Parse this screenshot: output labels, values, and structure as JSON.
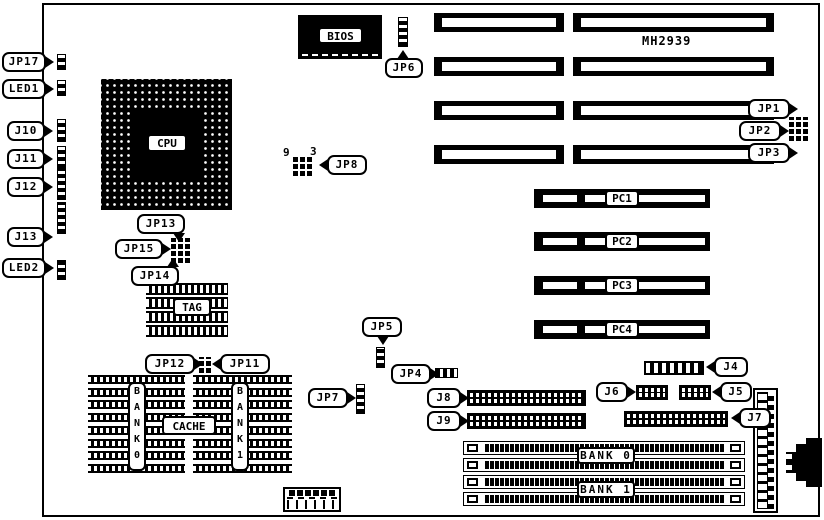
{
  "board": {
    "model_text": "MH2939"
  },
  "left_edge": {
    "jp17": "JP17",
    "led1": "LED1",
    "j10": "J10",
    "j11": "J11",
    "j12": "J12",
    "j13": "J13",
    "led2": "LED2"
  },
  "cpu": {
    "label": "CPU"
  },
  "bios": {
    "label": "BIOS",
    "jp6": "JP6"
  },
  "jp8": {
    "label": "JP8",
    "pin_top_left": "9",
    "pin_top_right": "3"
  },
  "isa": {
    "jp1": "JP1",
    "jp2": "JP2",
    "jp3": "JP3"
  },
  "pci": {
    "pc1": "PC1",
    "pc2": "PC2",
    "pc3": "PC3",
    "pc4": "PC4"
  },
  "tag": {
    "label": "TAG",
    "jp13": "JP13",
    "jp15": "JP15",
    "jp14": "JP14"
  },
  "cache": {
    "label": "CACHE",
    "bank0_vertical": "BANK0",
    "bank1_vertical": "BANK1",
    "jp12": "JP12",
    "jp11": "JP11"
  },
  "jumpers": {
    "jp5": "JP5",
    "jp4": "JP4",
    "jp7": "JP7"
  },
  "connectors": {
    "j8": "J8",
    "j9": "J9",
    "j4": "J4",
    "j6": "J6",
    "j5": "J5",
    "j7": "J7"
  },
  "memory": {
    "bank0": "BANK 0",
    "bank1": "BANK 1"
  }
}
